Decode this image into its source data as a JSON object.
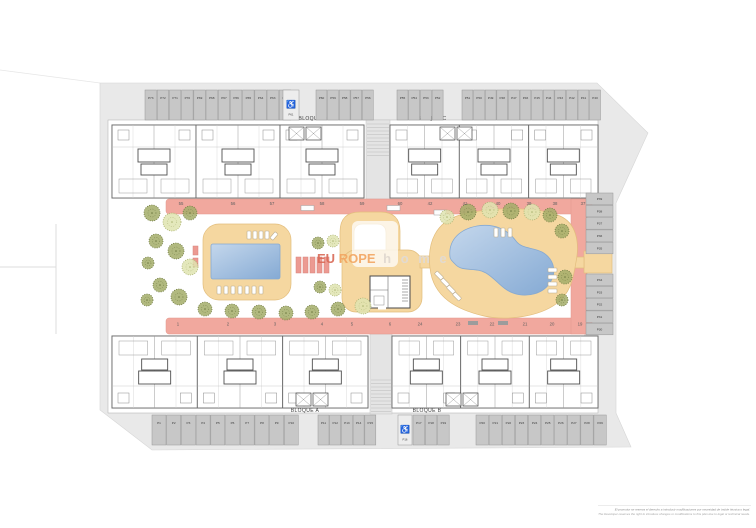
{
  "plan": {
    "colors": {
      "road": "#e9e9e9",
      "stall": "#c7c7c7",
      "parcel": "#ffffff",
      "path_pink": "#f1a89e",
      "deck": "#f5d7a0",
      "deck_edge": "#e2bd7c",
      "pool_light": "#c4d7ec",
      "pool_dark": "#85aad4",
      "tree_olive": "#a3ad68",
      "tree_olive_edge": "#6d7840",
      "tree_pale": "#dfe4b0",
      "tree_pale_edge": "#aab271",
      "wall": "#5c5c5c",
      "label_text": "#3d3d3d",
      "brand_red": "#d96a57",
      "brand_orange": "#f2a05a",
      "brand_gray": "#e0dbd7"
    },
    "icons": {
      "handicap": "♿"
    },
    "watermark": {
      "eu": "EU",
      "rope": "ROPE",
      "home": "h o m e"
    },
    "disclaimer": {
      "es": "El promotor se reserva el derecho a introducir modificaciones por necesidad de índole técnica o legal.",
      "en": "The Developer reserves the right to introduce changes or modifications to this plan due to legal or technical needs."
    },
    "blocks": [
      {
        "label": "BLOQUE D",
        "x": 112,
        "y": 125,
        "w": 252,
        "h": 73,
        "flip": false,
        "label_x": 313,
        "label_y": 120,
        "core_x": 289,
        "core_y": 127
      },
      {
        "label": "BLOQUE C",
        "x": 390,
        "y": 125,
        "w": 208,
        "h": 73,
        "flip": false,
        "label_x": 432,
        "label_y": 120,
        "core_x": 440,
        "core_y": 127
      },
      {
        "label": "BLOQUE A",
        "x": 112,
        "y": 336,
        "w": 256,
        "h": 72,
        "flip": true,
        "label_x": 305,
        "label_y": 412,
        "core_x": 296,
        "core_y": 393
      },
      {
        "label": "BLOQUE B",
        "x": 392,
        "y": 336,
        "w": 206,
        "h": 72,
        "flip": true,
        "label_x": 427,
        "label_y": 412,
        "core_x": 446,
        "core_y": 393
      }
    ],
    "plot_numbers": [
      {
        "v": "55",
        "x": 181,
        "y": 205
      },
      {
        "v": "56",
        "x": 233,
        "y": 205
      },
      {
        "v": "57",
        "x": 272,
        "y": 205
      },
      {
        "v": "58",
        "x": 322,
        "y": 205
      },
      {
        "v": "59",
        "x": 362,
        "y": 205
      },
      {
        "v": "60",
        "x": 400,
        "y": 205
      },
      {
        "v": "42",
        "x": 430,
        "y": 205
      },
      {
        "v": "41",
        "x": 465,
        "y": 205
      },
      {
        "v": "40",
        "x": 498,
        "y": 205
      },
      {
        "v": "39",
        "x": 529,
        "y": 205
      },
      {
        "v": "38",
        "x": 555,
        "y": 205
      },
      {
        "v": "37",
        "x": 583,
        "y": 205
      },
      {
        "v": "1",
        "x": 178,
        "y": 325.5
      },
      {
        "v": "2",
        "x": 228,
        "y": 325.5
      },
      {
        "v": "3",
        "x": 275,
        "y": 325.5
      },
      {
        "v": "4",
        "x": 322,
        "y": 325.5
      },
      {
        "v": "5",
        "x": 352,
        "y": 325.5
      },
      {
        "v": "6",
        "x": 390,
        "y": 325.5
      },
      {
        "v": "24",
        "x": 420,
        "y": 325.5
      },
      {
        "v": "23",
        "x": 458,
        "y": 325.5
      },
      {
        "v": "22",
        "x": 492,
        "y": 325.5
      },
      {
        "v": "21",
        "x": 525,
        "y": 325.5
      },
      {
        "v": "20",
        "x": 552,
        "y": 325.5
      },
      {
        "v": "19",
        "x": 580,
        "y": 325.5
      }
    ],
    "parking_rows": [
      {
        "name": "top-1",
        "x": 145,
        "y": 90,
        "w": 11.5,
        "h": 30,
        "labels": [
          "P73",
          "P72",
          "P71",
          "P70",
          "P69",
          "P68",
          "P67",
          "P66",
          "P65",
          "P64",
          "P63",
          "P62"
        ]
      },
      {
        "name": "top-hc",
        "x": 283,
        "y": 90,
        "w": 16,
        "h": 30,
        "handicap": true,
        "labels": [
          "P61"
        ]
      },
      {
        "name": "top-2",
        "x": 316,
        "y": 90,
        "w": 10.9,
        "h": 30,
        "labels": [
          "P60",
          "P59",
          "P58",
          "P57",
          "P56"
        ]
      },
      {
        "name": "top-3",
        "x": 397,
        "y": 90,
        "w": 11,
        "h": 30,
        "labels": [
          "P55",
          "P54",
          "P53",
          "P52"
        ]
      },
      {
        "name": "top-4",
        "x": 462,
        "y": 90,
        "w": 10.9,
        "h": 30,
        "labels": [
          "P51",
          "P50",
          "P49",
          "P48",
          "P47",
          "P46",
          "P45",
          "P44",
          "P43",
          "P42",
          "P41",
          "P40"
        ]
      },
      {
        "name": "right-1",
        "x": 586,
        "y": 193,
        "w": 27,
        "h": 11.6,
        "vertical": true,
        "labels": [
          "P39",
          "P38",
          "P37",
          "P36",
          "P35"
        ]
      },
      {
        "name": "right-2",
        "x": 586,
        "y": 274,
        "w": 27,
        "h": 11.6,
        "vertical": true,
        "labels": [
          "P34",
          "P33",
          "P32",
          "P31",
          "P30"
        ]
      },
      {
        "name": "bottom-1",
        "x": 152,
        "y": 415,
        "w": 14,
        "h": 30,
        "labels": [
          "P1",
          "P2",
          "P3",
          "P4",
          "P5",
          "P6",
          "P7",
          "P8",
          "P9",
          "P10"
        ]
      },
      {
        "name": "bottom-2",
        "x": 318,
        "y": 415,
        "w": 11,
        "h": 30,
        "labels": [
          "P11",
          "P12",
          "P13",
          "P14",
          "P15"
        ]
      },
      {
        "name": "bottom-hc",
        "x": 398,
        "y": 415,
        "w": 14,
        "h": 30,
        "handicap": true,
        "labels": [
          "P16"
        ]
      },
      {
        "name": "bottom-3",
        "x": 413,
        "y": 415,
        "w": 11.6,
        "h": 30,
        "labels": [
          "P17",
          "P18",
          "P19"
        ]
      },
      {
        "name": "bottom-4",
        "x": 476,
        "y": 415,
        "w": 12.4,
        "h": 30,
        "labels": [
          "P20",
          "P21",
          "P22",
          "P23",
          "P24",
          "P25",
          "P26",
          "P27",
          "P28",
          "P29"
        ]
      }
    ],
    "trees": [
      [
        152,
        213,
        8,
        0
      ],
      [
        172,
        222,
        9,
        1
      ],
      [
        190,
        213,
        7,
        0
      ],
      [
        156,
        241,
        7,
        0
      ],
      [
        176,
        251,
        8,
        0
      ],
      [
        148,
        263,
        6,
        0
      ],
      [
        190,
        267,
        8,
        1
      ],
      [
        160,
        285,
        7,
        0
      ],
      [
        179,
        297,
        8,
        0
      ],
      [
        147,
        300,
        6,
        0
      ],
      [
        205,
        309,
        7,
        0
      ],
      [
        232,
        311,
        7,
        0
      ],
      [
        259,
        312,
        7,
        0
      ],
      [
        286,
        313,
        7,
        0
      ],
      [
        312,
        312,
        7,
        0
      ],
      [
        338,
        309,
        7,
        0
      ],
      [
        363,
        306,
        8,
        1
      ],
      [
        318,
        243,
        6,
        0
      ],
      [
        333,
        241,
        6,
        1
      ],
      [
        320,
        287,
        6,
        0
      ],
      [
        335,
        290,
        6,
        1
      ],
      [
        447,
        217,
        7,
        1
      ],
      [
        468,
        212,
        8,
        0
      ],
      [
        490,
        210,
        8,
        1
      ],
      [
        511,
        211,
        8,
        0
      ],
      [
        532,
        212,
        8,
        1
      ],
      [
        550,
        215,
        7,
        0
      ],
      [
        562,
        231,
        7,
        0
      ],
      [
        565,
        277,
        7,
        0
      ],
      [
        562,
        300,
        6,
        0
      ]
    ],
    "loungers": [
      [
        247,
        231,
        4,
        8,
        0
      ],
      [
        253,
        231,
        4,
        8,
        0
      ],
      [
        259,
        231,
        4,
        8,
        0
      ],
      [
        265,
        231,
        4,
        8,
        0
      ],
      [
        272,
        232,
        4,
        8,
        40
      ],
      [
        217,
        286,
        4,
        8,
        0
      ],
      [
        224,
        286,
        4,
        8,
        0
      ],
      [
        231,
        286,
        4,
        8,
        0
      ],
      [
        238,
        286,
        4,
        8,
        0
      ],
      [
        245,
        286,
        4,
        8,
        0
      ],
      [
        252,
        286,
        4,
        8,
        0
      ],
      [
        259,
        286,
        4,
        8,
        0
      ],
      [
        494,
        228,
        4,
        9,
        0
      ],
      [
        501,
        228,
        4,
        9,
        0
      ],
      [
        508,
        228,
        4,
        9,
        0
      ],
      [
        437,
        271,
        4,
        9,
        -45
      ],
      [
        443,
        278,
        4,
        9,
        -45
      ],
      [
        449,
        285,
        4,
        9,
        -45
      ],
      [
        455,
        292,
        4,
        9,
        -45
      ],
      [
        548,
        268,
        9,
        4,
        0
      ],
      [
        548,
        275,
        9,
        4,
        0
      ],
      [
        548,
        282,
        9,
        4,
        0
      ],
      [
        548,
        289,
        9,
        4,
        0
      ]
    ],
    "benches": [
      {
        "x": 301,
        "y": 205.5,
        "w": 13,
        "h": 5,
        "tone": "white"
      },
      {
        "x": 387,
        "y": 205.5,
        "w": 13,
        "h": 5,
        "tone": "white"
      },
      {
        "x": 434,
        "y": 210,
        "w": 12,
        "h": 5,
        "tone": "white"
      },
      {
        "x": 468,
        "y": 321,
        "w": 10,
        "h": 4,
        "tone": "dark"
      },
      {
        "x": 498,
        "y": 321,
        "w": 10,
        "h": 4,
        "tone": "dark"
      }
    ],
    "planters": [
      {
        "x": 296,
        "y": 257,
        "w": 5,
        "h": 16
      },
      {
        "x": 303,
        "y": 257,
        "w": 5,
        "h": 16
      },
      {
        "x": 310,
        "y": 257,
        "w": 5,
        "h": 16
      },
      {
        "x": 317,
        "y": 257,
        "w": 5,
        "h": 16
      },
      {
        "x": 324,
        "y": 257,
        "w": 5,
        "h": 16
      },
      {
        "x": 193,
        "y": 246,
        "w": 5,
        "h": 9
      },
      {
        "x": 193,
        "y": 258,
        "w": 5,
        "h": 9
      }
    ]
  }
}
